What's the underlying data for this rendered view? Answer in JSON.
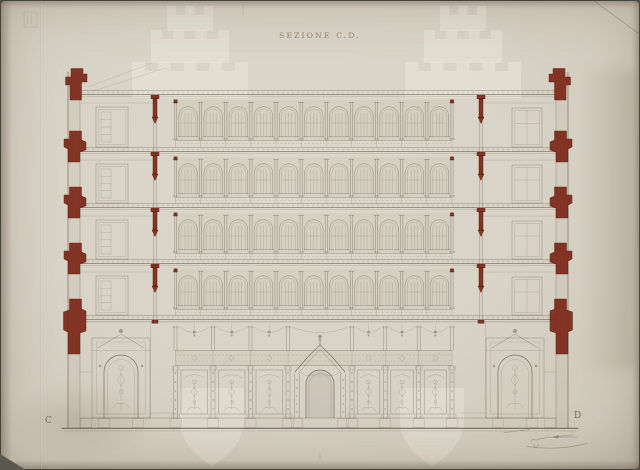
{
  "title": {
    "text": "SEZIONE C.D."
  },
  "corner_markers": {
    "left": "C",
    "right": "D"
  },
  "colors": {
    "background": "#5b5850",
    "paper": "#d8d3c6",
    "ink": "#5d5446",
    "poche_red": "#7c2718",
    "title_ink": "#8d7457",
    "watermark": "#ebe8dc"
  },
  "drawing": {
    "floor_lines_y": [
      95,
      152,
      208,
      264,
      320
    ],
    "ground_base_y": 428,
    "arcade": {
      "x_start": 175.5,
      "x_end": 452,
      "bays": 11,
      "rows": 4
    },
    "walls": {
      "left_outer_x": 68,
      "left_inner_x": 80,
      "right_inner_x": 556,
      "right_outer_x": 568,
      "partition_left_x": 155,
      "partition_right_x": 481
    },
    "ground": {
      "pilasters_x": [
        175.5,
        213,
        250.5,
        288,
        352,
        385.3,
        418.7,
        452
      ],
      "canopy_center_x": 320,
      "niche_centers_x": [
        121,
        515
      ],
      "frieze_band_y": [
        350.5,
        365.5
      ],
      "panel_band_y": [
        366,
        418
      ]
    }
  },
  "watermarks": {
    "top_castles_cx": [
      190,
      463
    ],
    "bottom_shields_x": [
      180,
      400
    ]
  },
  "handwriting": {
    "present": true
  }
}
